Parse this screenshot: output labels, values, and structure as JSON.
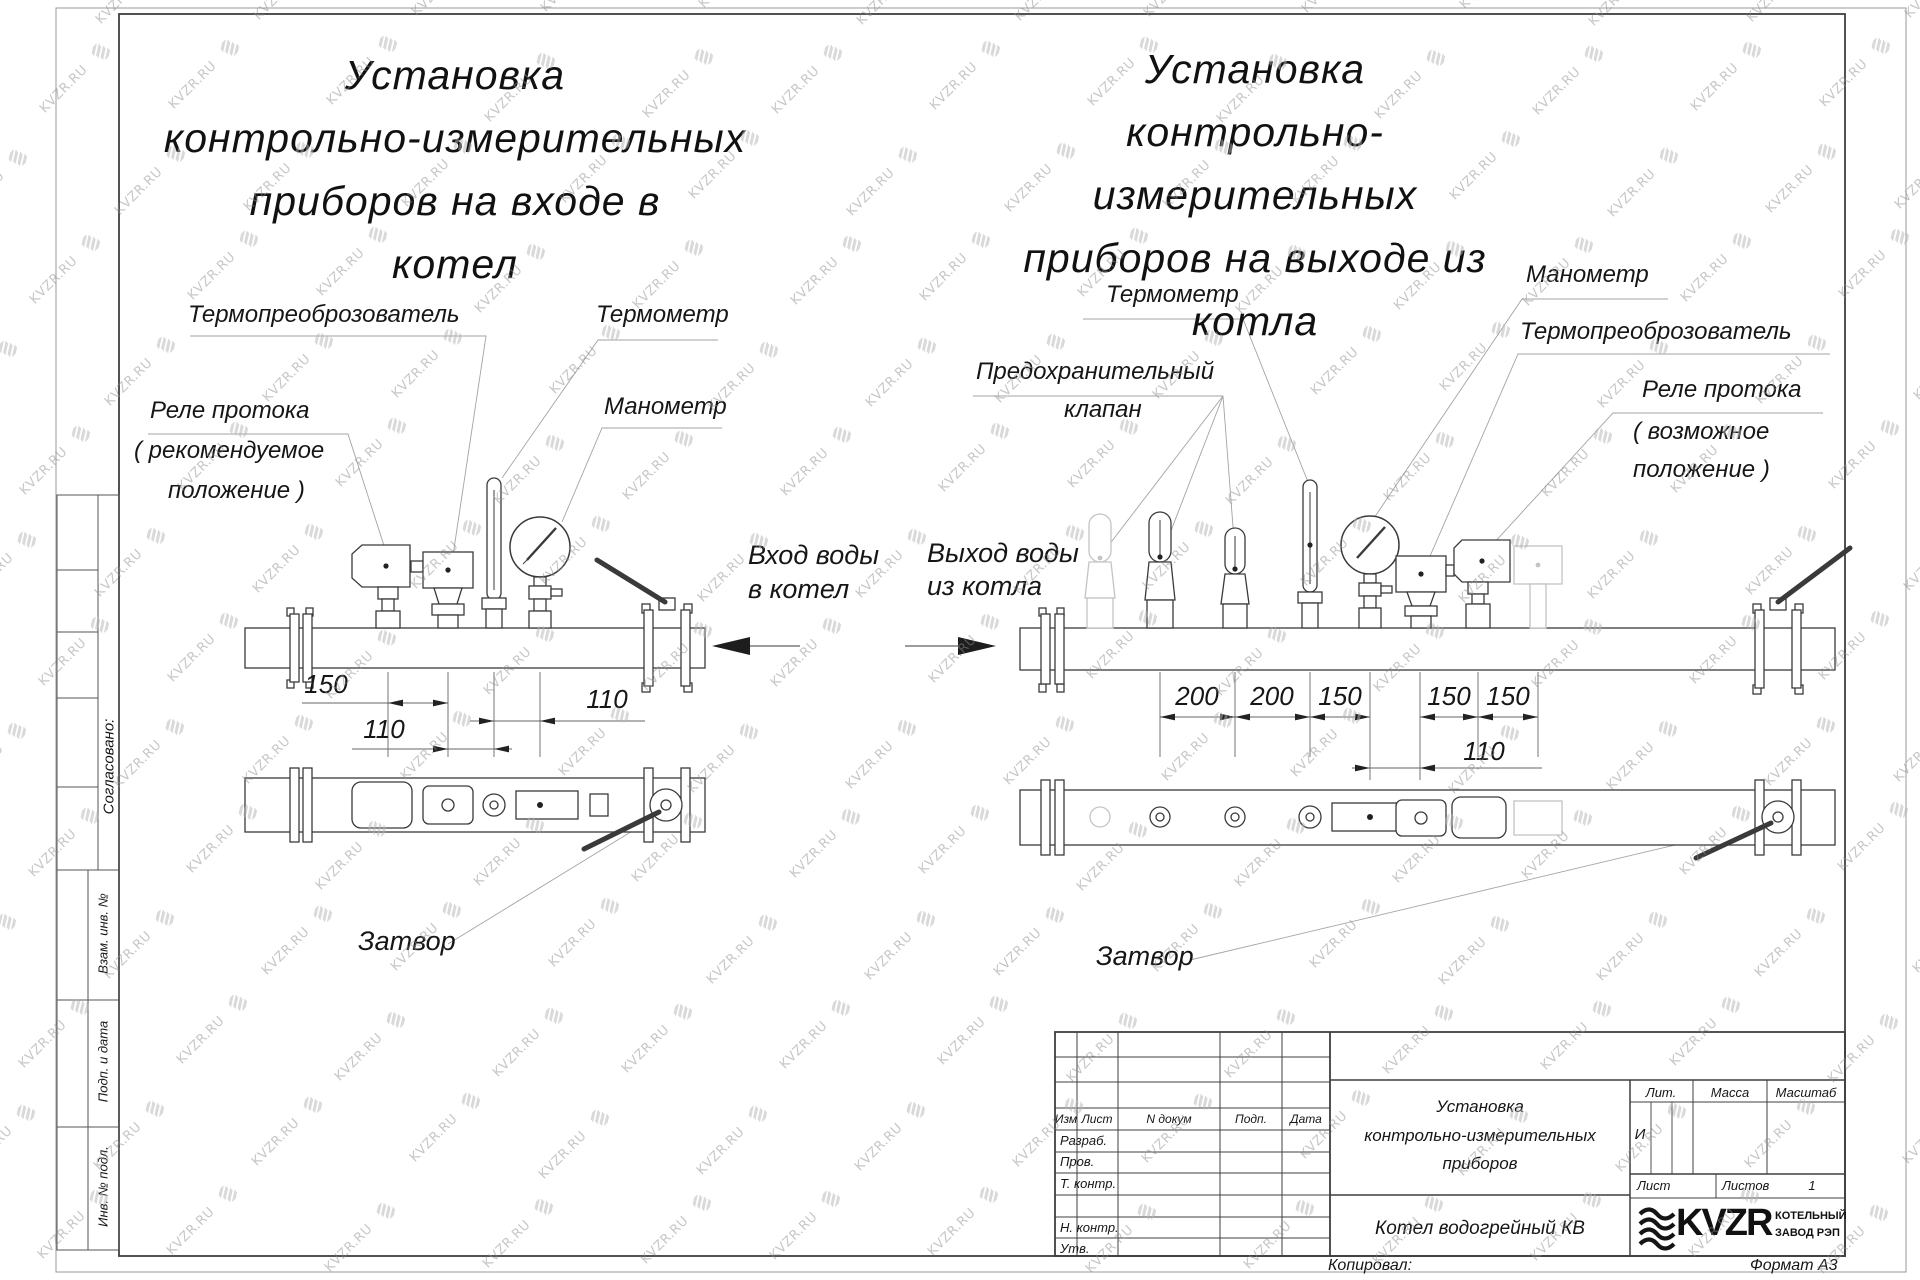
{
  "watermark": {
    "text": "KVZR.RU"
  },
  "left_view": {
    "title": [
      "Установка",
      "контрольно-измерительных",
      "приборов на входе в",
      "котел"
    ],
    "labels": {
      "flow_relay": "Реле протока",
      "flow_relay_note1": "( рекомендуемое",
      "flow_relay_note2": "положение )",
      "thermo_transducer": "Термопреоброзователь",
      "thermometer": "Термометр",
      "pressure_gauge": "Манометр",
      "valve": "Затвор",
      "flow_in1": "Вход воды",
      "flow_in2": "в котел"
    },
    "dimensions": [
      "150",
      "110",
      "110"
    ]
  },
  "right_view": {
    "title": [
      "Установка",
      "контрольно-измерительных",
      "приборов на выходе из",
      "котла"
    ],
    "labels": {
      "thermometer": "Термометр",
      "safety_valve1": "Предохранительный",
      "safety_valve2": "клапан",
      "pressure_gauge": "Манометр",
      "thermo_transducer": "Термопреоброзователь",
      "flow_relay": "Реле протока",
      "flow_relay_note1": "( возможное",
      "flow_relay_note2": "положение )",
      "valve": "Затвор",
      "flow_out1": "Выход воды",
      "flow_out2": "из котла"
    },
    "dimensions": [
      "200",
      "200",
      "150",
      "150",
      "150",
      "110"
    ]
  },
  "sidebar": {
    "agreed": "Согласовано:",
    "replacement_inv": "Взам. инв. №",
    "sign_date": "Подп. и дата",
    "inventory": "Инв. № подл."
  },
  "title_block": {
    "header": {
      "izm": "Изм",
      "sheet": "Лист",
      "doc": "N докум",
      "sign": "Подп.",
      "date": "Дата"
    },
    "rows": [
      "Разраб.",
      "Пров.",
      "Т. контр.",
      "Н. контр.",
      "Утв."
    ],
    "doc_name": [
      "Установка",
      "контрольно-измерительных",
      "приборов"
    ],
    "product": "Котел водогрейный КВ",
    "lit_label": "Лит.",
    "lit_value": "И",
    "mass_label": "Масса",
    "scale_label": "Масштаб",
    "sheet_label": "Лист",
    "sheets_label": "Листов",
    "sheets_value": "1",
    "logo": {
      "brand": "KVZR",
      "org1": "КОТЕЛЬНЫЙ",
      "org2": "ЗАВОД РЭП"
    },
    "copied": "Копировал:",
    "format": "Формат А3"
  }
}
